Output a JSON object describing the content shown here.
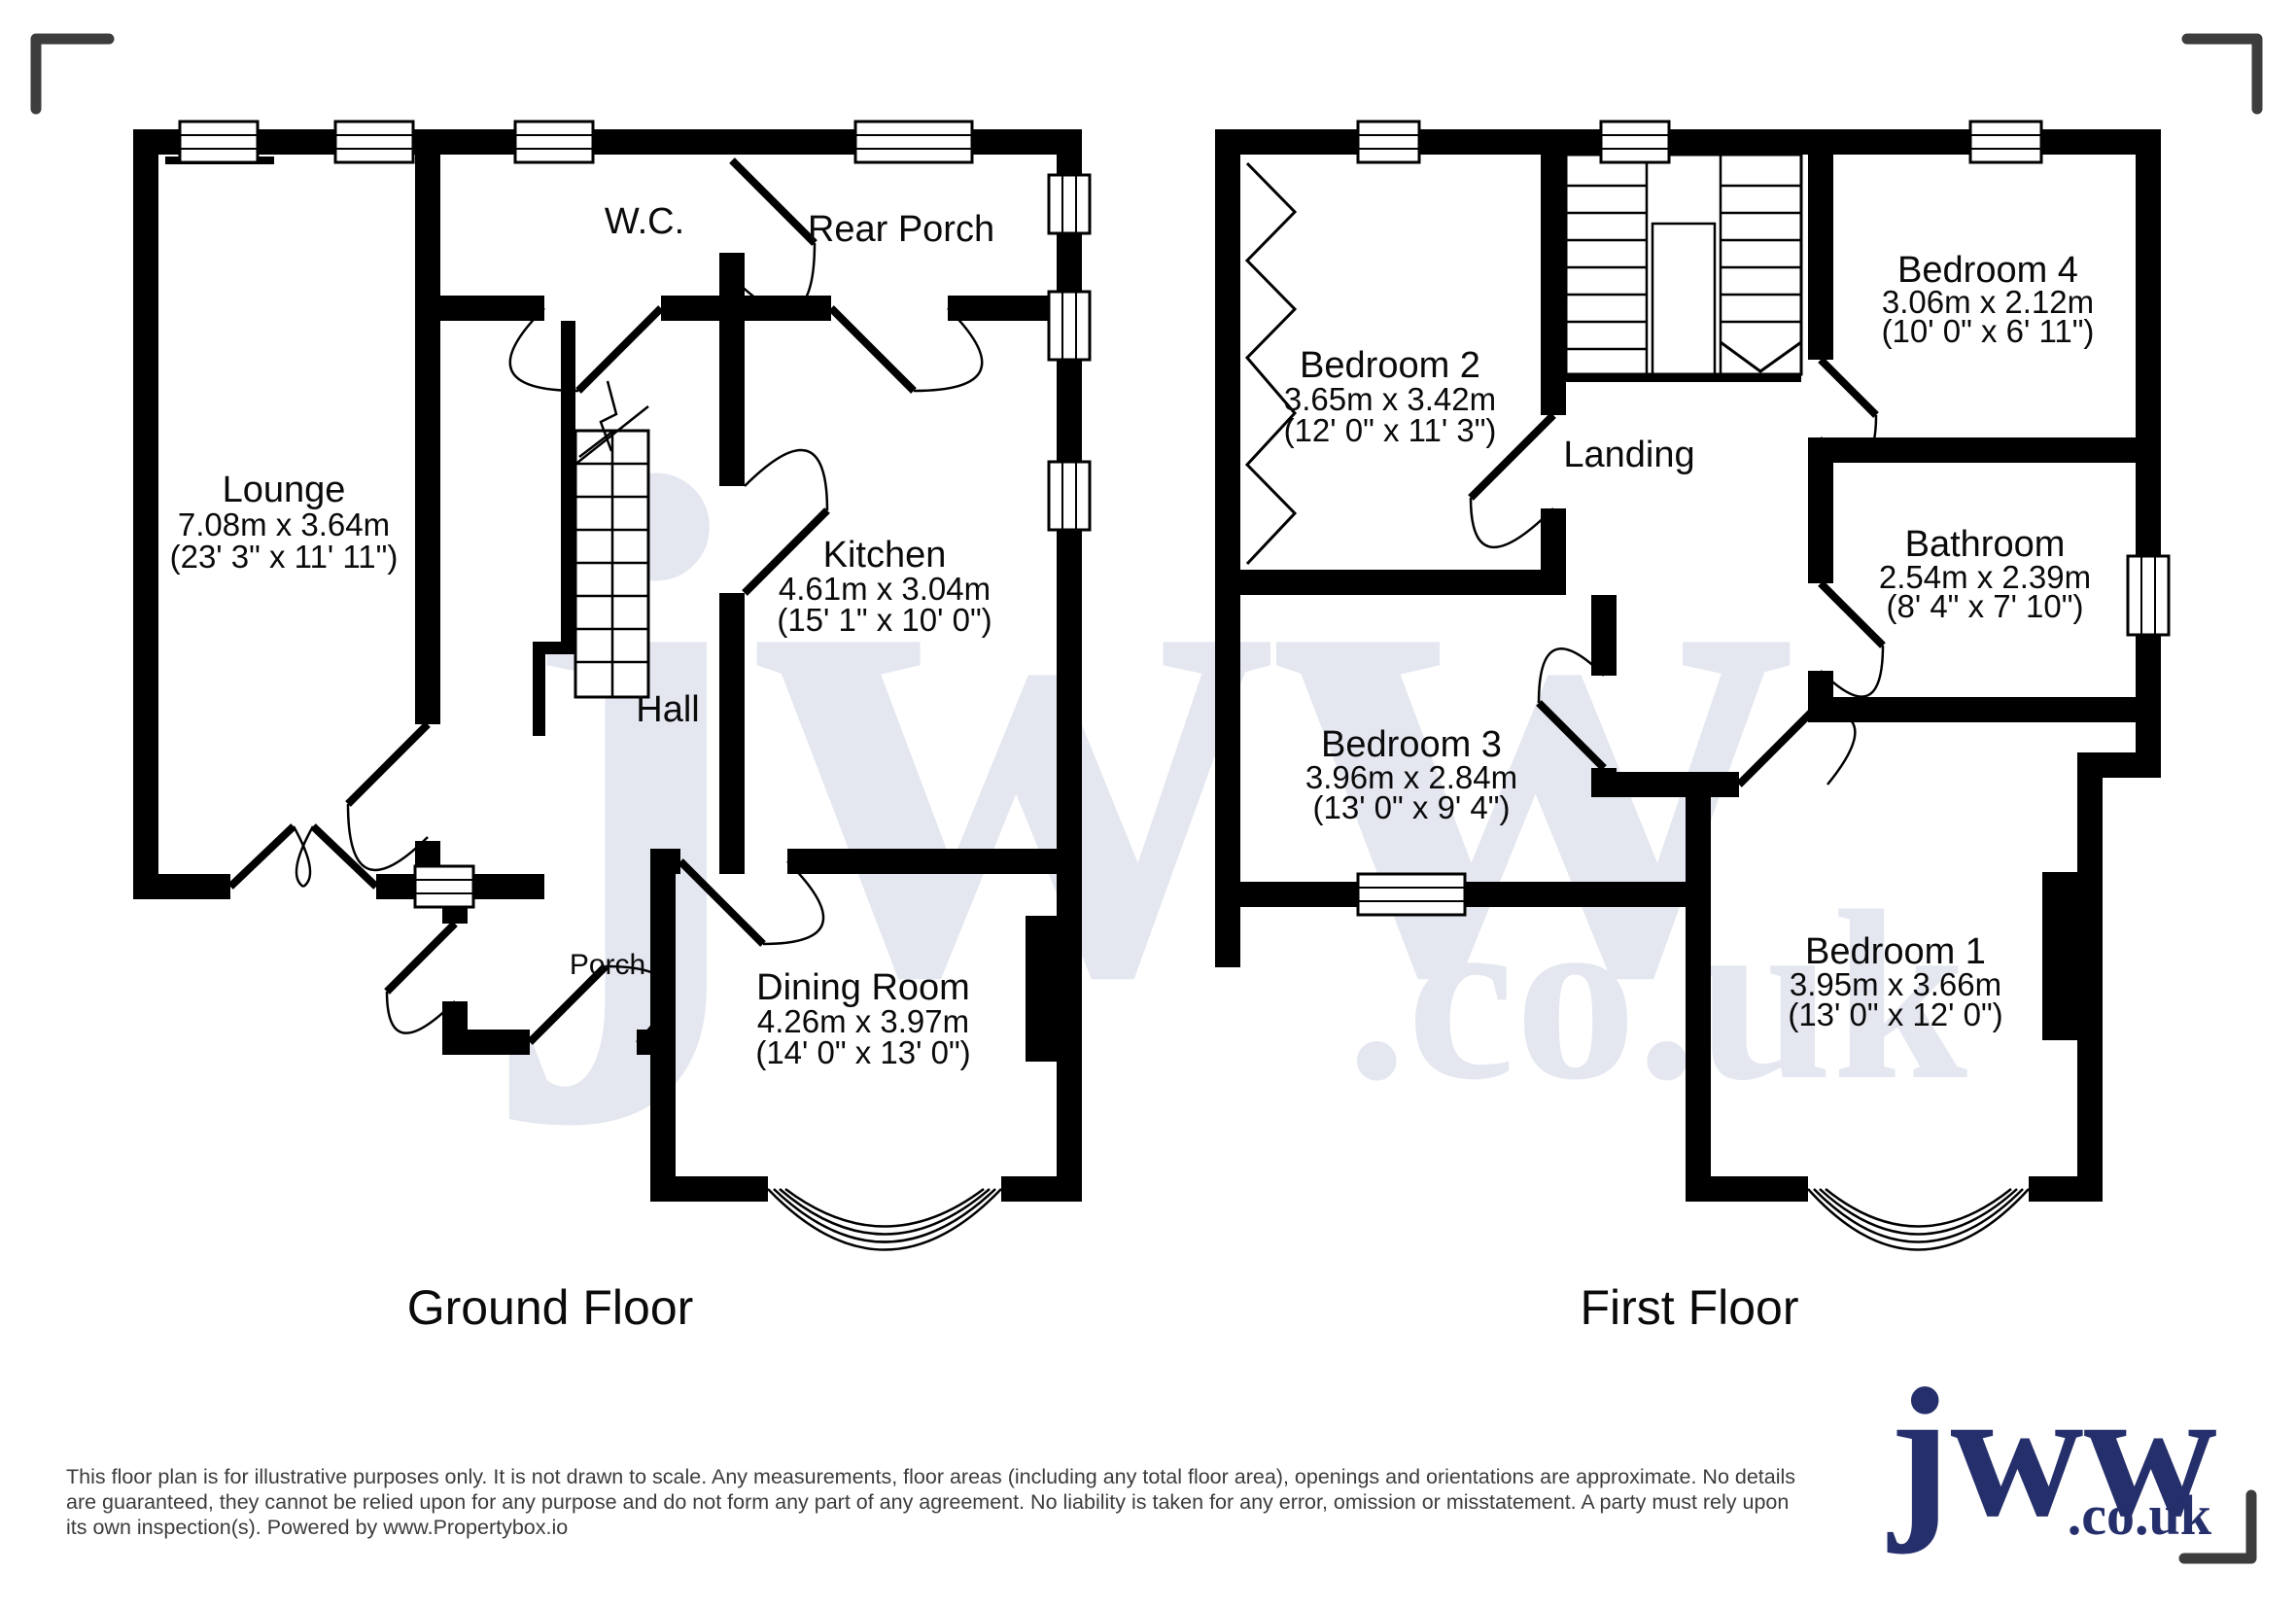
{
  "watermark": {
    "brand": "jww",
    "domain": ".co.uk"
  },
  "logo": {
    "brand": "jww",
    "domain": ".co.uk",
    "color": "#252f6b"
  },
  "floors": [
    {
      "title": "Ground Floor",
      "rooms": {
        "lounge": {
          "name": "Lounge",
          "metric": "7.08m x 3.64m",
          "imperial": "(23' 3\" x 11' 11\")"
        },
        "wc": {
          "name": "W.C."
        },
        "rear_porch": {
          "name": "Rear Porch"
        },
        "kitchen": {
          "name": "Kitchen",
          "metric": "4.61m x 3.04m",
          "imperial": "(15' 1\" x 10' 0\")"
        },
        "hall": {
          "name": "Hall"
        },
        "porch": {
          "name": "Porch"
        },
        "dining_room": {
          "name": "Dining Room",
          "metric": "4.26m x 3.97m",
          "imperial": "(14' 0\" x 13' 0\")"
        }
      }
    },
    {
      "title": "First Floor",
      "rooms": {
        "bedroom2": {
          "name": "Bedroom 2",
          "metric": "3.65m x 3.42m",
          "imperial": "(12' 0\" x 11' 3\")"
        },
        "landing": {
          "name": "Landing"
        },
        "bedroom4": {
          "name": "Bedroom 4",
          "metric": "3.06m x 2.12m",
          "imperial": "(10' 0\" x 6' 11\")"
        },
        "bathroom": {
          "name": "Bathroom",
          "metric": "2.54m x 2.39m",
          "imperial": "(8' 4\" x 7' 10\")"
        },
        "bedroom3": {
          "name": "Bedroom 3",
          "metric": "3.96m x 2.84m",
          "imperial": "(13' 0\" x 9' 4\")"
        },
        "bedroom1": {
          "name": "Bedroom 1",
          "metric": "3.95m x 3.66m",
          "imperial": "(13' 0\" x 12' 0\")"
        }
      }
    }
  ],
  "disclaimer": {
    "line1": "This floor plan is for illustrative purposes only. It is not drawn to scale. Any measurements, floor areas (including any total floor area), openings and orientations are approximate. No details",
    "line2": "are guaranteed, they cannot be relied upon for any purpose and do not form any part of any agreement. No liability is taken for any error, omission or misstatement. A party must rely upon",
    "line3": "its own inspection(s). Powered by www.Propertybox.io"
  }
}
